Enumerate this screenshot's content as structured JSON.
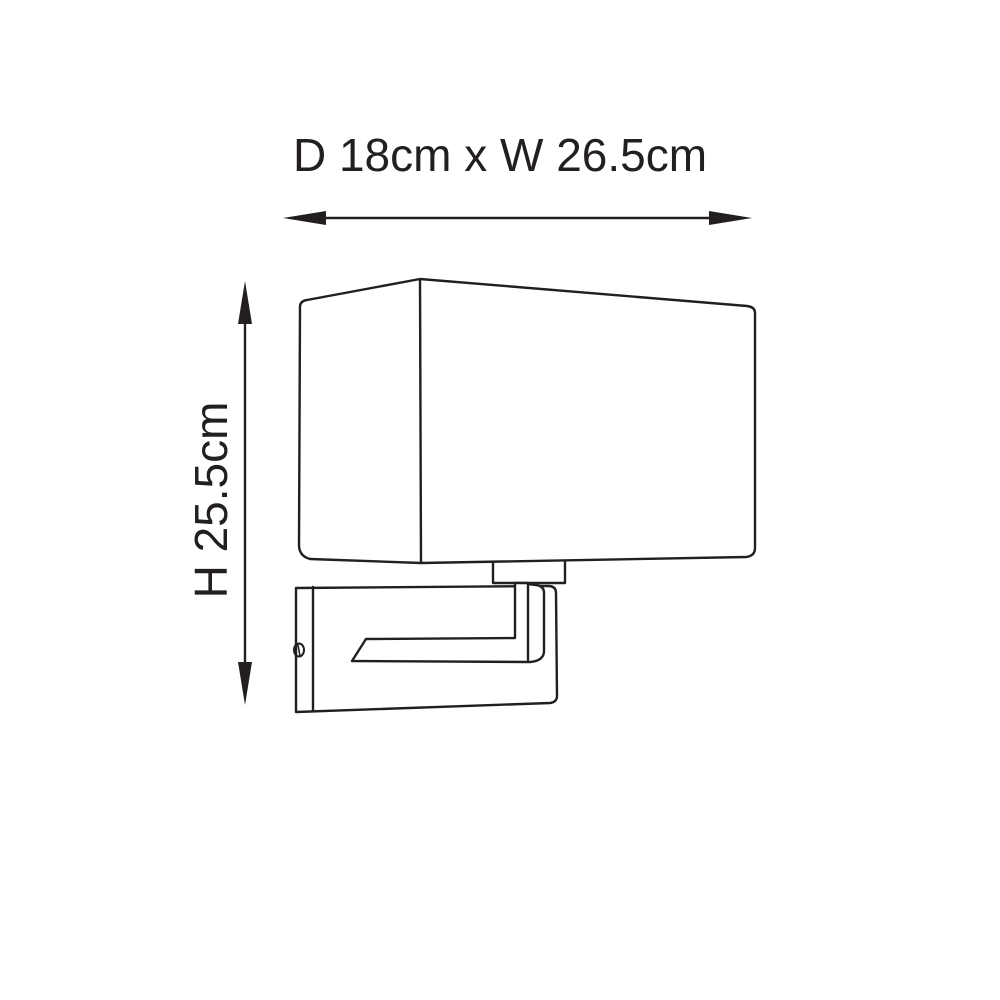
{
  "page": {
    "background": "#ffffff",
    "line_color": "#231f20",
    "text_color": "#231f20"
  },
  "dimensions": {
    "width": {
      "label": "D 18cm x W 26.5cm",
      "axis": "horizontal"
    },
    "height": {
      "label": "H 25.5cm",
      "axis": "vertical"
    }
  }
}
